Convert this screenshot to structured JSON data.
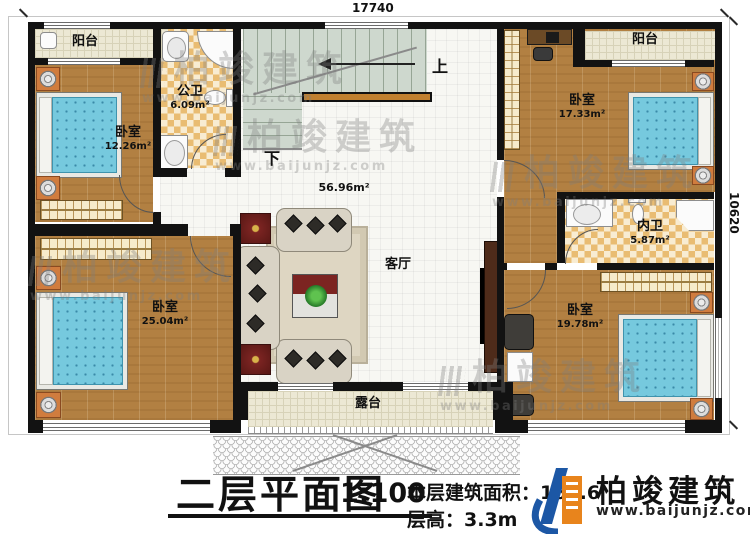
{
  "sheet": {
    "dim_top": "17740",
    "dim_right": "10620"
  },
  "rooms": {
    "balcony_tl": {
      "label": "阳台"
    },
    "bedroom_tl": {
      "label": "卧室",
      "area": "12.26m²"
    },
    "bath_public": {
      "label": "公卫",
      "area": "6.09m²"
    },
    "bedroom_bl": {
      "label": "卧室",
      "area": "25.04m²"
    },
    "living": {
      "label": "客厅",
      "area": "56.96m²"
    },
    "stairs": {
      "up": "上",
      "down": "下"
    },
    "balcony_tr": {
      "label": "阳台"
    },
    "bedroom_tr": {
      "label": "卧室",
      "area": "17.33m²"
    },
    "bath_private": {
      "label": "内卫",
      "area": "5.87m²"
    },
    "bedroom_br": {
      "label": "卧室",
      "area": "19.78m²"
    },
    "terrace": {
      "label": "露台"
    }
  },
  "title_block": {
    "title": "二层平面图",
    "scale": "1:100",
    "area_text": "本层建筑面积：166.6",
    "floor_height_text": "层高：3.3m"
  },
  "brand": {
    "name": "柏竣建筑",
    "website": "www.baijunjz.com"
  }
}
